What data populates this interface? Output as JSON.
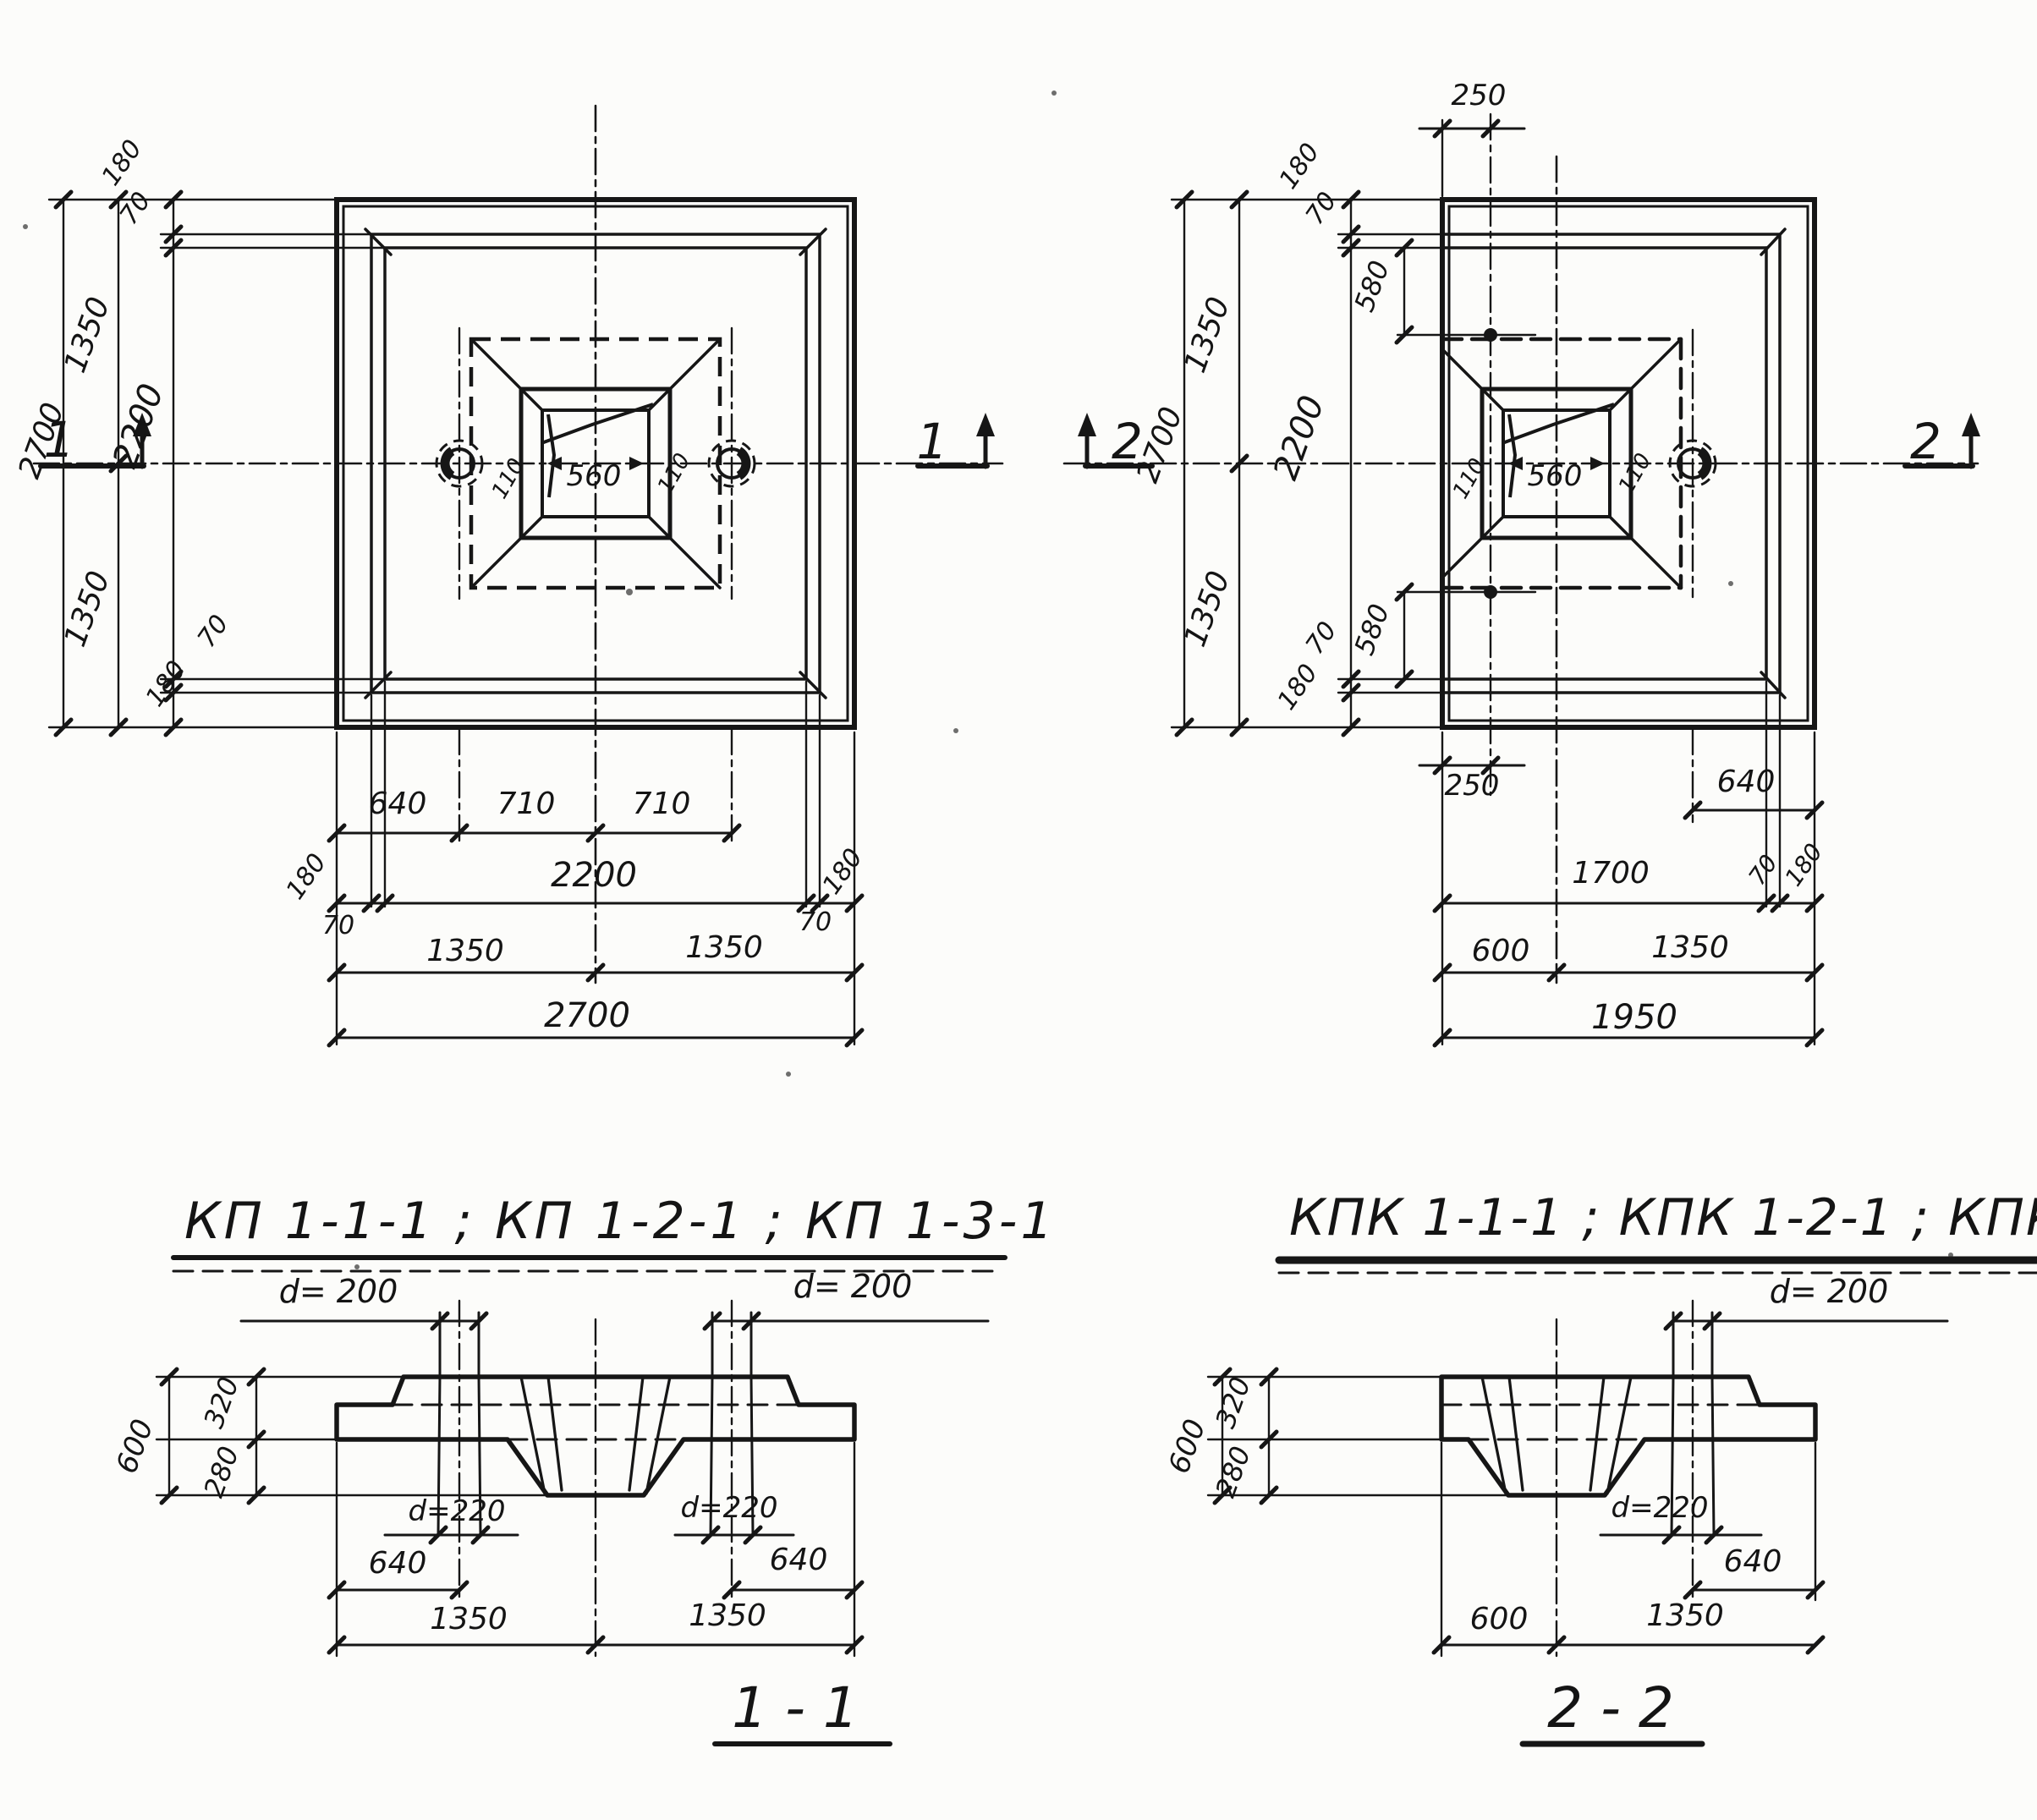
{
  "document": {
    "kind": "foundation-cap construction drawing",
    "left_title": "КП 1-1-1 ; КП 1-2-1 ; КП 1-3-1",
    "right_title": "КПК 1-1-1 ; КПК 1-2-1 ; КПК 1-3-1",
    "section_left_title": "1 - 1",
    "section_right_title": "2 - 2"
  },
  "labels": [
    {
      "name": "lp-dim-2700-left",
      "text": "2700"
    },
    {
      "name": "lp-dim-1350-upper-left",
      "text": "1350"
    },
    {
      "name": "lp-dim-1350-lower-left",
      "text": "1350"
    },
    {
      "name": "lp-dim-180-top-left",
      "text": "180"
    },
    {
      "name": "lp-dim-70-top-left",
      "text": "70"
    },
    {
      "name": "lp-dim-2200-left",
      "text": "2200"
    },
    {
      "name": "lp-dim-70-bottom-left-side",
      "text": "70"
    },
    {
      "name": "lp-dim-180-bottom-left-side",
      "text": "180"
    },
    {
      "name": "lp-dim-640-bottom",
      "text": "640"
    },
    {
      "name": "lp-dim-710-bottom-1",
      "text": "710"
    },
    {
      "name": "lp-dim-710-bottom-2",
      "text": "710"
    },
    {
      "name": "lp-dim-180-bottom-l",
      "text": "180"
    },
    {
      "name": "lp-dim-2200-bottom",
      "text": "2200"
    },
    {
      "name": "lp-dim-180-bottom-r",
      "text": "180"
    },
    {
      "name": "lp-dim-70-bottom-l",
      "text": "70"
    },
    {
      "name": "lp-dim-70-bottom-r",
      "text": "70"
    },
    {
      "name": "lp-dim-1350-bottom-1",
      "text": "1350"
    },
    {
      "name": "lp-dim-1350-bottom-2",
      "text": "1350"
    },
    {
      "name": "lp-dim-2700-bottom",
      "text": "2700"
    },
    {
      "name": "lp-pocket-110-left",
      "text": "110"
    },
    {
      "name": "lp-pocket-560",
      "text": "560"
    },
    {
      "name": "lp-pocket-110-right",
      "text": "110"
    },
    {
      "name": "lp-section-marker-1-west",
      "text": "1"
    },
    {
      "name": "lp-section-marker-1-east",
      "text": "1"
    },
    {
      "name": "rp-dim-2700-left",
      "text": "2700"
    },
    {
      "name": "rp-dim-1350-upper-left",
      "text": "1350"
    },
    {
      "name": "rp-dim-1350-lower-left",
      "text": "1350"
    },
    {
      "name": "rp-dim-2200-left",
      "text": "2200"
    },
    {
      "name": "rp-dim-180-top-left",
      "text": "180"
    },
    {
      "name": "rp-dim-70-top-left",
      "text": "70"
    },
    {
      "name": "rp-dim-580-top",
      "text": "580"
    },
    {
      "name": "rp-dim-580-bottom",
      "text": "580"
    },
    {
      "name": "rp-dim-70-bottom-left",
      "text": "70"
    },
    {
      "name": "rp-dim-180-bottom-left",
      "text": "180"
    },
    {
      "name": "rp-dim-250-top",
      "text": "250"
    },
    {
      "name": "rp-dim-250-bottom",
      "text": "250"
    },
    {
      "name": "rp-dim-640-bottom",
      "text": "640"
    },
    {
      "name": "rp-dim-1700-bottom",
      "text": "1700"
    },
    {
      "name": "rp-dim-70-bottom-right",
      "text": "70"
    },
    {
      "name": "rp-dim-180-bottom-right",
      "text": "180"
    },
    {
      "name": "rp-dim-600-bottom",
      "text": "600"
    },
    {
      "name": "rp-dim-1350-bottom",
      "text": "1350"
    },
    {
      "name": "rp-dim-1950-bottom",
      "text": "1950"
    },
    {
      "name": "rp-pocket-110-left",
      "text": "110"
    },
    {
      "name": "rp-pocket-560",
      "text": "560"
    },
    {
      "name": "rp-pocket-110-right",
      "text": "110"
    },
    {
      "name": "rp-section-marker-2-west",
      "text": "2"
    },
    {
      "name": "rp-section-marker-2-east",
      "text": "2"
    },
    {
      "name": "title-left",
      "text": "КП 1-1-1 ; КП 1-2-1 ; КП 1-3-1"
    },
    {
      "name": "title-right",
      "text": "КПК 1-1-1 ; КПК 1-2-1 ; КПК 1-3-1"
    },
    {
      "name": "s1-d200-left",
      "text": "d= 200"
    },
    {
      "name": "s1-d200-right",
      "text": "d= 200"
    },
    {
      "name": "s1-d220-left",
      "text": "d=220"
    },
    {
      "name": "s1-d220-right",
      "text": "d=220"
    },
    {
      "name": "s1-dim-600",
      "text": "600"
    },
    {
      "name": "s1-dim-320",
      "text": "320"
    },
    {
      "name": "s1-dim-280",
      "text": "280"
    },
    {
      "name": "s1-dim-640-left",
      "text": "640"
    },
    {
      "name": "s1-dim-640-right",
      "text": "640"
    },
    {
      "name": "s1-dim-1350-left",
      "text": "1350"
    },
    {
      "name": "s1-dim-1350-right",
      "text": "1350"
    },
    {
      "name": "s1-title",
      "text": "1 - 1"
    },
    {
      "name": "s2-d200",
      "text": "d= 200"
    },
    {
      "name": "s2-d220",
      "text": "d=220"
    },
    {
      "name": "s2-dim-600",
      "text": "600"
    },
    {
      "name": "s2-dim-320",
      "text": "320"
    },
    {
      "name": "s2-dim-280",
      "text": "280"
    },
    {
      "name": "s2-dim-640",
      "text": "640"
    },
    {
      "name": "s2-dim-600-bottom",
      "text": "600"
    },
    {
      "name": "s2-dim-1350-bottom",
      "text": "1350"
    },
    {
      "name": "s2-title",
      "text": "2 - 2"
    }
  ]
}
